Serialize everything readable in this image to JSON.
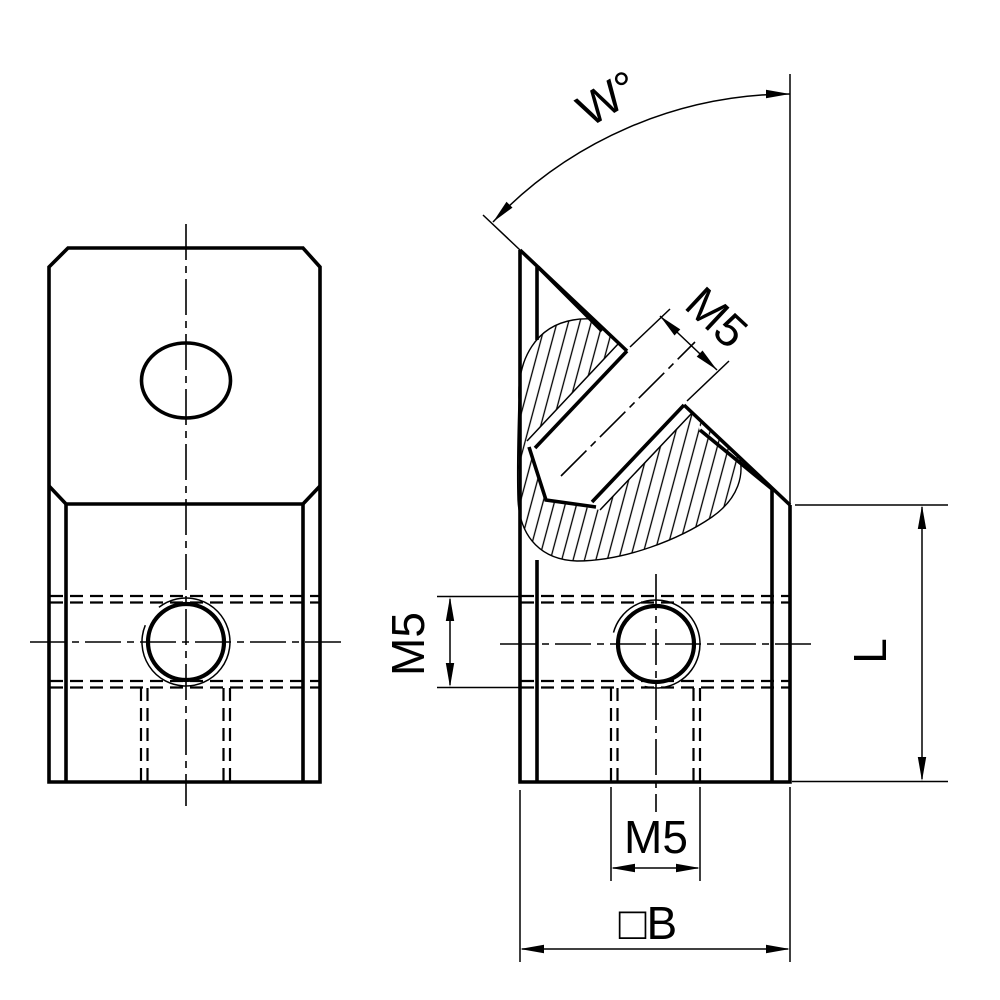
{
  "drawing": {
    "title": "angle-connector-two-view-technical-drawing",
    "colors": {
      "background": "#ffffff",
      "line": "#000000"
    },
    "labels": {
      "angle": "W°",
      "angled_thread": "M5",
      "side_thread": "M5",
      "bottom_thread": "M5",
      "base_width": "□B",
      "height": "L"
    }
  }
}
